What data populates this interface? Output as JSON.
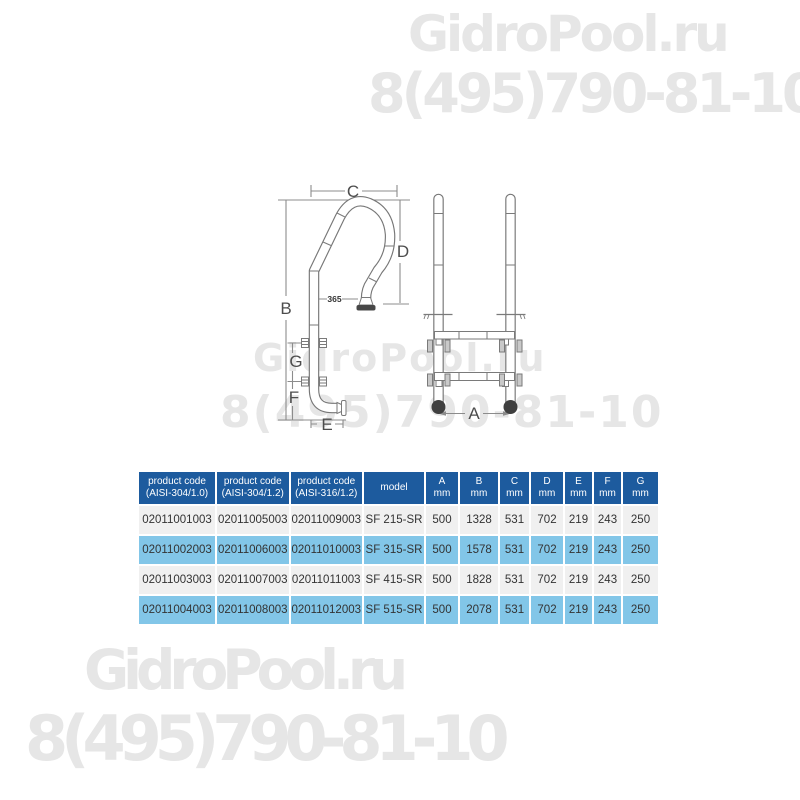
{
  "watermark": {
    "brand": "GidroPool.ru",
    "phone": "8(495)790-81-10",
    "color": "#e6e6e6"
  },
  "diagram": {
    "dim_labels": {
      "A": "A",
      "B": "B",
      "C": "C",
      "D": "D",
      "E": "E",
      "F": "F",
      "G": "G"
    },
    "inline_dimension": "365"
  },
  "table": {
    "colors": {
      "header_bg": "#1d5b9e",
      "row_bg": "#f0f0f0",
      "row_alt_bg": "#82c6e8",
      "text": "#333333"
    },
    "headers": [
      {
        "line1": "product code",
        "line2": "(AISI-304/1.0)"
      },
      {
        "line1": "product code",
        "line2": "(AISI-304/1.2)"
      },
      {
        "line1": "product code",
        "line2": "(AISI-316/1.2)"
      },
      {
        "line1": "model",
        "line2": ""
      },
      {
        "line1": "A",
        "line2": "mm"
      },
      {
        "line1": "B",
        "line2": "mm"
      },
      {
        "line1": "C",
        "line2": "mm"
      },
      {
        "line1": "D",
        "line2": "mm"
      },
      {
        "line1": "E",
        "line2": "mm"
      },
      {
        "line1": "F",
        "line2": "mm"
      },
      {
        "line1": "G",
        "line2": "mm"
      }
    ],
    "rows": [
      [
        "02011001003",
        "02011005003",
        "02011009003",
        "SF 215-SR",
        "500",
        "1328",
        "531",
        "702",
        "219",
        "243",
        "250"
      ],
      [
        "02011002003",
        "02011006003",
        "02011010003",
        "SF 315-SR",
        "500",
        "1578",
        "531",
        "702",
        "219",
        "243",
        "250"
      ],
      [
        "02011003003",
        "02011007003",
        "02011011003",
        "SF 415-SR",
        "500",
        "1828",
        "531",
        "702",
        "219",
        "243",
        "250"
      ],
      [
        "02011004003",
        "02011008003",
        "02011012003",
        "SF 515-SR",
        "500",
        "2078",
        "531",
        "702",
        "219",
        "243",
        "250"
      ]
    ]
  }
}
